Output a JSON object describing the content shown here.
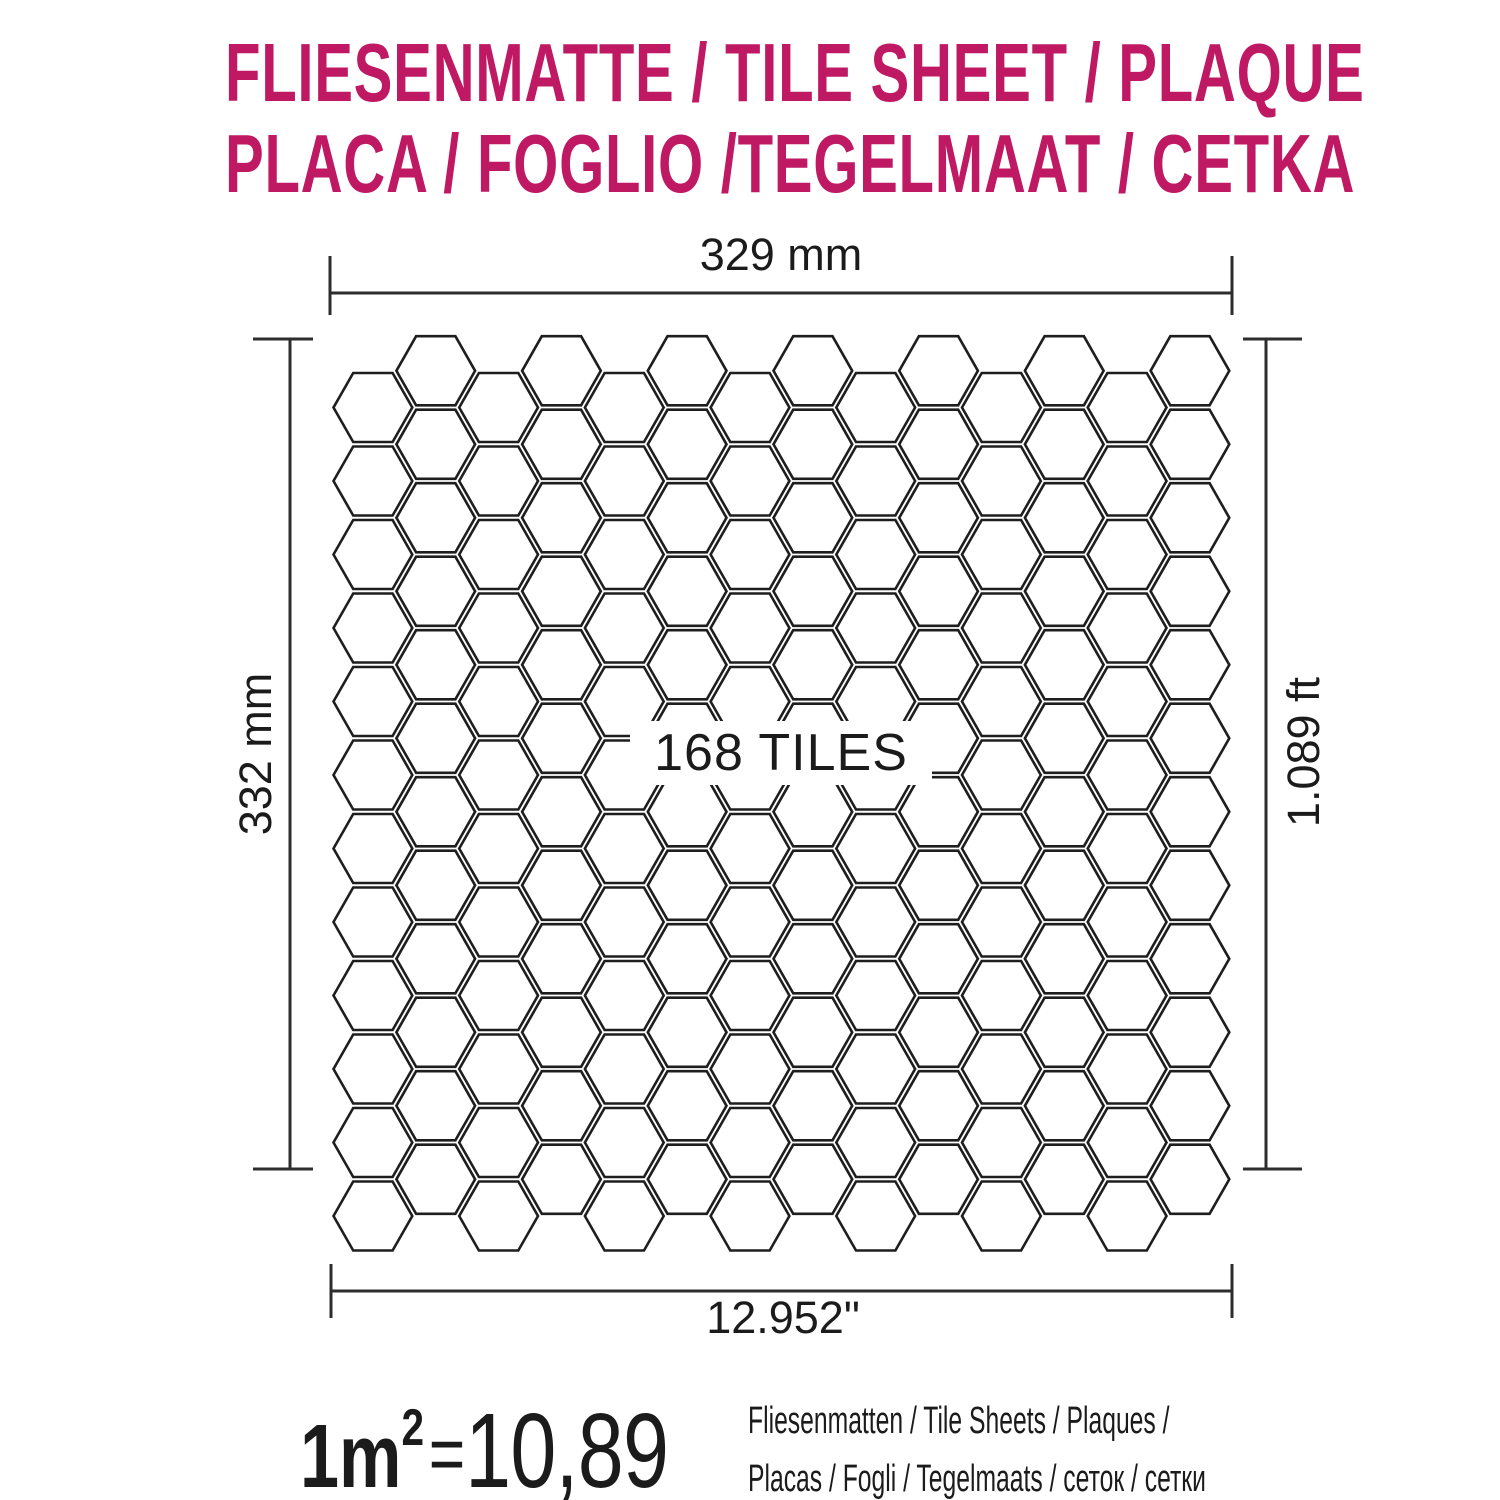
{
  "title": {
    "line1": "FLIESENMATTE / TILE SHEET / PLAQUE",
    "line2": "PLACA / FOGLIO /TEGELMAAT / CETKA",
    "color": "#bf1963"
  },
  "dimensions": {
    "top": "329 mm",
    "left": "332 mm",
    "right": "1.089 ft",
    "bottom": "12.952\""
  },
  "sheet": {
    "tiles_label": "168 TILES",
    "grid": {
      "tile_shape": "hexagon",
      "columns": 14,
      "rows": 12
    },
    "stroke_color": "#1e1e1e"
  },
  "coverage": {
    "area_label": "1m",
    "area_exponent": "2",
    "equals": "=",
    "value": "10,89",
    "units_line1": "Fliesenmatten / Tile Sheets /  Plaques /",
    "units_line2": "Placas / Fogli / Tegelmaats / сеток / сетки"
  }
}
